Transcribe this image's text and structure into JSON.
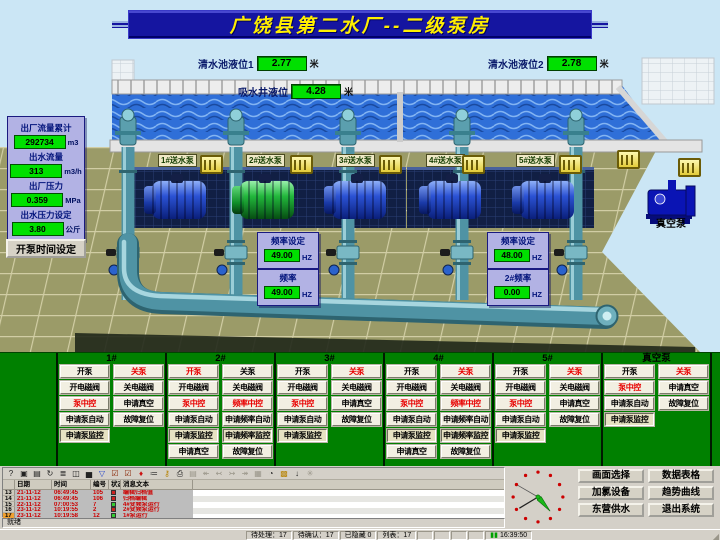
{
  "title": "广饶县第二水厂--二级泵房",
  "levels": {
    "tank1": {
      "label": "清水池液位1",
      "value": "2.77",
      "unit": "米"
    },
    "tank2": {
      "label": "清水池液位2",
      "value": "2.78",
      "unit": "米"
    },
    "well": {
      "label": "吸水井液位",
      "value": "4.28",
      "unit": "米"
    }
  },
  "metrics": {
    "items": [
      {
        "label": "出厂流量累计",
        "value": "292734",
        "unit": "m3"
      },
      {
        "label": "出水流量",
        "value": "313",
        "unit": "m3/h"
      },
      {
        "label": "出厂压力",
        "value": "0.359",
        "unit": "MPa"
      },
      {
        "label": "出水压力设定",
        "value": "3.80",
        "unit": "公斤"
      }
    ]
  },
  "pump_time_button": "开泵时间设定",
  "pumps": [
    {
      "label": "1#送水泵",
      "state": "stopped"
    },
    {
      "label": "2#送水泵",
      "state": "running"
    },
    {
      "label": "3#送水泵",
      "state": "stopped"
    },
    {
      "label": "4#送水泵",
      "state": "stopped"
    },
    {
      "label": "5#送水泵",
      "state": "stopped"
    }
  ],
  "vacuum_pump": {
    "label": "真空泵"
  },
  "freq_panels": [
    {
      "title": "频率设定",
      "value": "49.00",
      "unit": "HZ",
      "setpoint": true
    },
    {
      "title": "频率",
      "value": "49.00",
      "unit": "HZ",
      "setpoint": false
    },
    {
      "title": "频率设定",
      "value": "48.00",
      "unit": "HZ",
      "setpoint": true
    },
    {
      "title": "2#频率",
      "value": "0.00",
      "unit": "HZ",
      "setpoint": false
    }
  ],
  "control_columns": [
    {
      "header": "1#",
      "buttons": [
        {
          "label": "开泵"
        },
        {
          "label": "关泵",
          "red": true
        },
        {
          "label": "开电磁阀"
        },
        {
          "label": "关电磁阀"
        },
        {
          "label": "泵中控",
          "red": true
        },
        {
          "label": "申请真空"
        },
        {
          "label": "申请泵自动"
        },
        {
          "label": "故障复位"
        },
        {
          "label": "申请泵监控",
          "pressed": true
        }
      ]
    },
    {
      "header": "2#",
      "buttons": [
        {
          "label": "开泵",
          "red": true
        },
        {
          "label": "关泵"
        },
        {
          "label": "开电磁阀"
        },
        {
          "label": "关电磁阀"
        },
        {
          "label": "泵中控",
          "red": true
        },
        {
          "label": "频率中控",
          "red": true
        },
        {
          "label": "申请泵自动"
        },
        {
          "label": "申请频率自动"
        },
        {
          "label": "申请泵监控",
          "pressed": true
        },
        {
          "label": "申请频率监控",
          "pressed": true
        },
        {
          "label": "申请真空"
        },
        {
          "label": "故障复位"
        }
      ]
    },
    {
      "header": "3#",
      "buttons": [
        {
          "label": "开泵"
        },
        {
          "label": "关泵",
          "red": true
        },
        {
          "label": "开电磁阀"
        },
        {
          "label": "关电磁阀"
        },
        {
          "label": "泵中控",
          "red": true
        },
        {
          "label": "申请真空"
        },
        {
          "label": "申请泵自动"
        },
        {
          "label": "故障复位"
        },
        {
          "label": "申请泵监控",
          "pressed": true
        }
      ]
    },
    {
      "header": "4#",
      "buttons": [
        {
          "label": "开泵"
        },
        {
          "label": "关泵",
          "red": true
        },
        {
          "label": "开电磁阀"
        },
        {
          "label": "关电磁阀"
        },
        {
          "label": "泵中控",
          "red": true
        },
        {
          "label": "频率中控",
          "red": true
        },
        {
          "label": "申请泵自动"
        },
        {
          "label": "申请频率自动"
        },
        {
          "label": "申请泵监控",
          "pressed": true
        },
        {
          "label": "申请频率监控",
          "pressed": true
        },
        {
          "label": "申请真空"
        },
        {
          "label": "故障复位"
        }
      ]
    },
    {
      "header": "5#",
      "buttons": [
        {
          "label": "开泵"
        },
        {
          "label": "关泵",
          "red": true
        },
        {
          "label": "开电磁阀"
        },
        {
          "label": "关电磁阀"
        },
        {
          "label": "泵中控",
          "red": true
        },
        {
          "label": "申请真空"
        },
        {
          "label": "申请泵自动"
        },
        {
          "label": "故障复位"
        },
        {
          "label": "申请泵监控",
          "pressed": true
        }
      ]
    },
    {
      "header": "真空泵",
      "buttons": [
        {
          "label": "开泵"
        },
        {
          "label": "关泵",
          "red": true
        },
        {
          "label": "泵中控",
          "red": true
        },
        {
          "label": "申请真空"
        },
        {
          "label": "申请泵自动"
        },
        {
          "label": "故障复位"
        },
        {
          "label": "申请泵监控",
          "pressed": true
        }
      ]
    }
  ],
  "alarm": {
    "toolbar_icons": [
      {
        "name": "help-icon",
        "glyph": "?"
      },
      {
        "name": "window-icon",
        "glyph": "▣"
      },
      {
        "name": "notes-icon",
        "glyph": "▤"
      },
      {
        "name": "refresh-icon",
        "glyph": "↻"
      },
      {
        "name": "list-icon",
        "glyph": "≣"
      },
      {
        "name": "archive-icon",
        "glyph": "◫"
      },
      {
        "name": "chart-icon",
        "glyph": "▅"
      },
      {
        "name": "filter-icon",
        "glyph": "▽",
        "color": "#2244cc"
      },
      {
        "name": "ack-icon",
        "glyph": "☑",
        "color": "#882200"
      },
      {
        "name": "ack-all-icon",
        "glyph": "☑",
        "color": "#882200"
      },
      {
        "name": "pin-icon",
        "glyph": "♦",
        "color": "#cc1111"
      },
      {
        "name": "log-icon",
        "glyph": "≔"
      },
      {
        "name": "key-icon",
        "glyph": "⚷",
        "color": "#b8860b"
      },
      {
        "name": "print-icon",
        "glyph": "⎙"
      },
      {
        "name": "export-icon",
        "glyph": "▤",
        "disabled": true
      },
      {
        "name": "first-icon",
        "glyph": "↞",
        "disabled": true
      },
      {
        "name": "prev-icon",
        "glyph": "↢",
        "disabled": true
      },
      {
        "name": "next-icon",
        "glyph": "↣",
        "disabled": true
      },
      {
        "name": "last-icon",
        "glyph": "↠",
        "disabled": true
      },
      {
        "name": "frame-icon",
        "glyph": "▦",
        "disabled": true
      },
      {
        "name": "time-icon",
        "glyph": "◔"
      },
      {
        "name": "lock-icon",
        "glyph": "▩",
        "color": "#b8860b"
      },
      {
        "name": "sort-icon",
        "glyph": "↓"
      },
      {
        "name": "misc-icon",
        "glyph": "✳",
        "disabled": true
      }
    ],
    "columns": [
      "日期",
      "时间",
      "编号",
      "状态",
      "消息文本"
    ],
    "rows": [
      {
        "num": "13",
        "date": "21-11-12",
        "time": "06:49:45",
        "id": "105",
        "status": "red",
        "text": "编辑归档值",
        "selected": false
      },
      {
        "num": "14",
        "date": "21-11-12",
        "time": "06:49:45",
        "id": "106",
        "status": "red",
        "text": "归档编辑",
        "selected": false
      },
      {
        "num": "15",
        "date": "22-11-12",
        "time": "07:00:53",
        "id": "7",
        "status": "green",
        "text": "4#变频泵运行",
        "selected": false
      },
      {
        "num": "16",
        "date": "23-11-12",
        "time": "10:19:55",
        "id": "2",
        "status": "red",
        "text": "2#变频泵运行",
        "selected": false
      },
      {
        "num": "17",
        "date": "23-11-12",
        "time": "10:19:58",
        "id": "12",
        "status": "green",
        "text": "1#泵运行",
        "selected": true
      }
    ]
  },
  "status_text": "就绪",
  "nav_buttons": [
    "画面选择",
    "数据表格",
    "加氯设备",
    "趋势曲线",
    "东营供水",
    "退出系统"
  ],
  "taskbar": {
    "items": [
      "待处理：17",
      "待确认：17",
      "已隐藏 0",
      "列表：17"
    ],
    "time": "16:39:50"
  },
  "colors": {
    "accent_green_box": "#00e000",
    "panel_lavender": "#b2b2e4",
    "control_strip": "#008000",
    "title_bar": "#1515a0"
  }
}
